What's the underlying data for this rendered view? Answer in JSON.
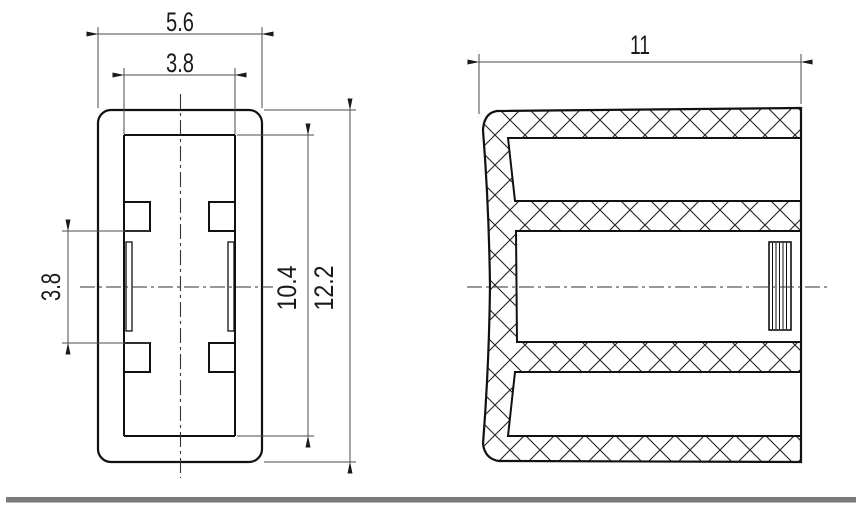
{
  "front_view": {
    "label_width_outer": "5.6",
    "label_width_inner": "3.8",
    "label_slot_height": "3.8",
    "label_inner_height": "10.4",
    "label_outer_height": "12.2"
  },
  "side_view": {
    "label_overall_width": "11"
  },
  "colors": {
    "part_line": "#111111",
    "dimension_line": "#4a4a4a",
    "centerline": "#333333",
    "hatch": "#222222",
    "divider": "#7a7a7a",
    "background": "#ffffff"
  }
}
